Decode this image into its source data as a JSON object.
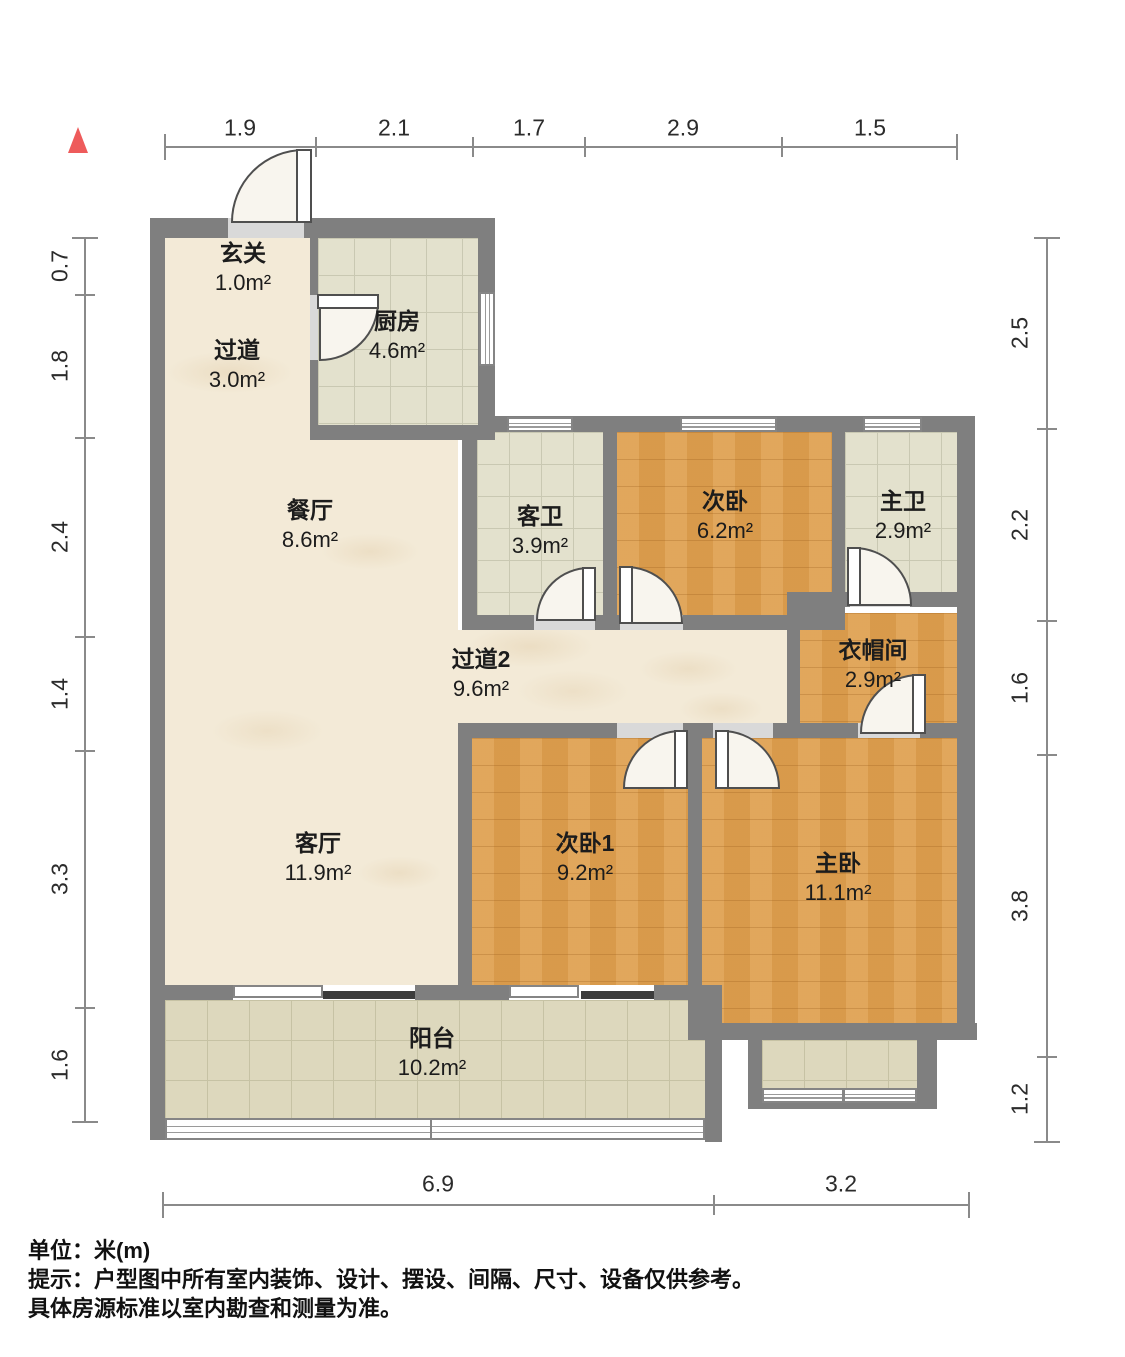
{
  "palette": {
    "wall": "#7f7f7f",
    "marble": "#f3ead7",
    "tile": "#e3e1cd",
    "tileline": "#c9c8b2",
    "wood": "#dfa050",
    "balcony": "#ddd8bd",
    "balconyline": "#c6c2a4",
    "accent": "#ee5b5b",
    "doorline": "#4f4f4f",
    "dimline": "#8a8a8a",
    "ink": "#1c1c1c"
  },
  "rooms": [
    {
      "name": "玄关",
      "area": "1.0m²"
    },
    {
      "name": "过道",
      "area": "3.0m²"
    },
    {
      "name": "厨房",
      "area": "4.6m²"
    },
    {
      "name": "餐厅",
      "area": "8.6m²"
    },
    {
      "name": "客卫",
      "area": "3.9m²"
    },
    {
      "name": "次卧",
      "area": "6.2m²"
    },
    {
      "name": "主卫",
      "area": "2.9m²"
    },
    {
      "name": "过道2",
      "area": "9.6m²"
    },
    {
      "name": "衣帽间",
      "area": "2.9m²"
    },
    {
      "name": "客厅",
      "area": "11.9m²"
    },
    {
      "name": "次卧1",
      "area": "9.2m²"
    },
    {
      "name": "主卧",
      "area": "11.1m²"
    },
    {
      "name": "阳台",
      "area": "10.2m²"
    }
  ],
  "dimensions": {
    "top": [
      "1.9",
      "2.1",
      "1.7",
      "2.9",
      "1.5"
    ],
    "left": [
      "0.7",
      "1.8",
      "2.4",
      "1.4",
      "3.3",
      "1.6"
    ],
    "right": [
      "2.5",
      "2.2",
      "1.6",
      "3.8",
      "1.2"
    ],
    "bottom": [
      "6.9",
      "3.2"
    ]
  },
  "footer": {
    "unit_line": "单位：米(m)",
    "tip_line1": "提示：户型图中所有室内装饰、设计、摆设、间隔、尺寸、设备仅供参考。",
    "tip_line2": "具体房源标准以室内勘查和测量为准。"
  }
}
